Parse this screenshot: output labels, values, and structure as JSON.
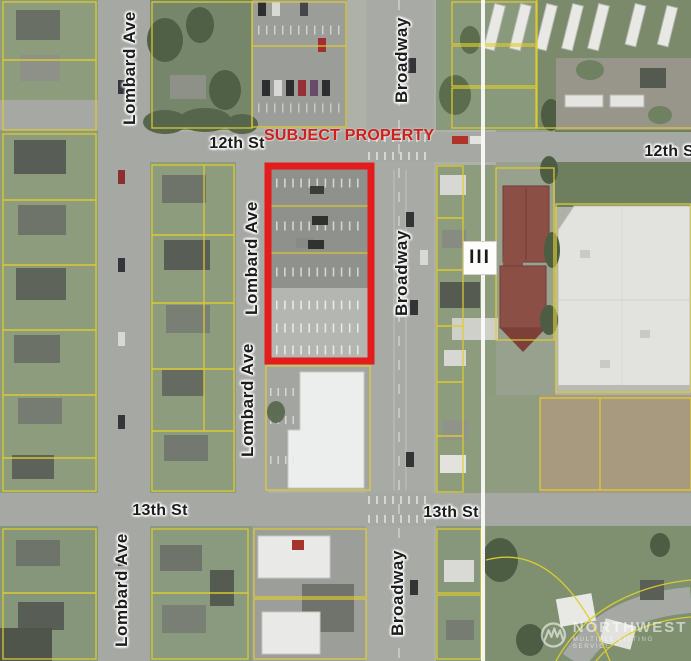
{
  "subject": {
    "label": "SUBJECT PROPERTY"
  },
  "streets": {
    "broadway": "Broadway",
    "lombard_ave": "Lombard Ave",
    "twelfth_st": "12th St",
    "twelfth_st_right": "12th St",
    "thirteenth_st": "13th St"
  },
  "icons": {
    "building_marker": "III",
    "nwmls_logo": "mountain-peaks-circle"
  },
  "watermark": {
    "name": "NORTHWEST",
    "tagline": "MULTIPLE LISTING SERVICE"
  },
  "colors": {
    "subject_outline": "#e31c1c",
    "subject_label_text": "#cf1f1c",
    "parcel_line": "#e0cd30",
    "road_gray": "#a6a8a3",
    "grass_green": "#8d9c7c",
    "power_line_white": "#fafaf8",
    "red_roof_building": "#8c4f46",
    "dirt_field": "#a79a7e"
  }
}
